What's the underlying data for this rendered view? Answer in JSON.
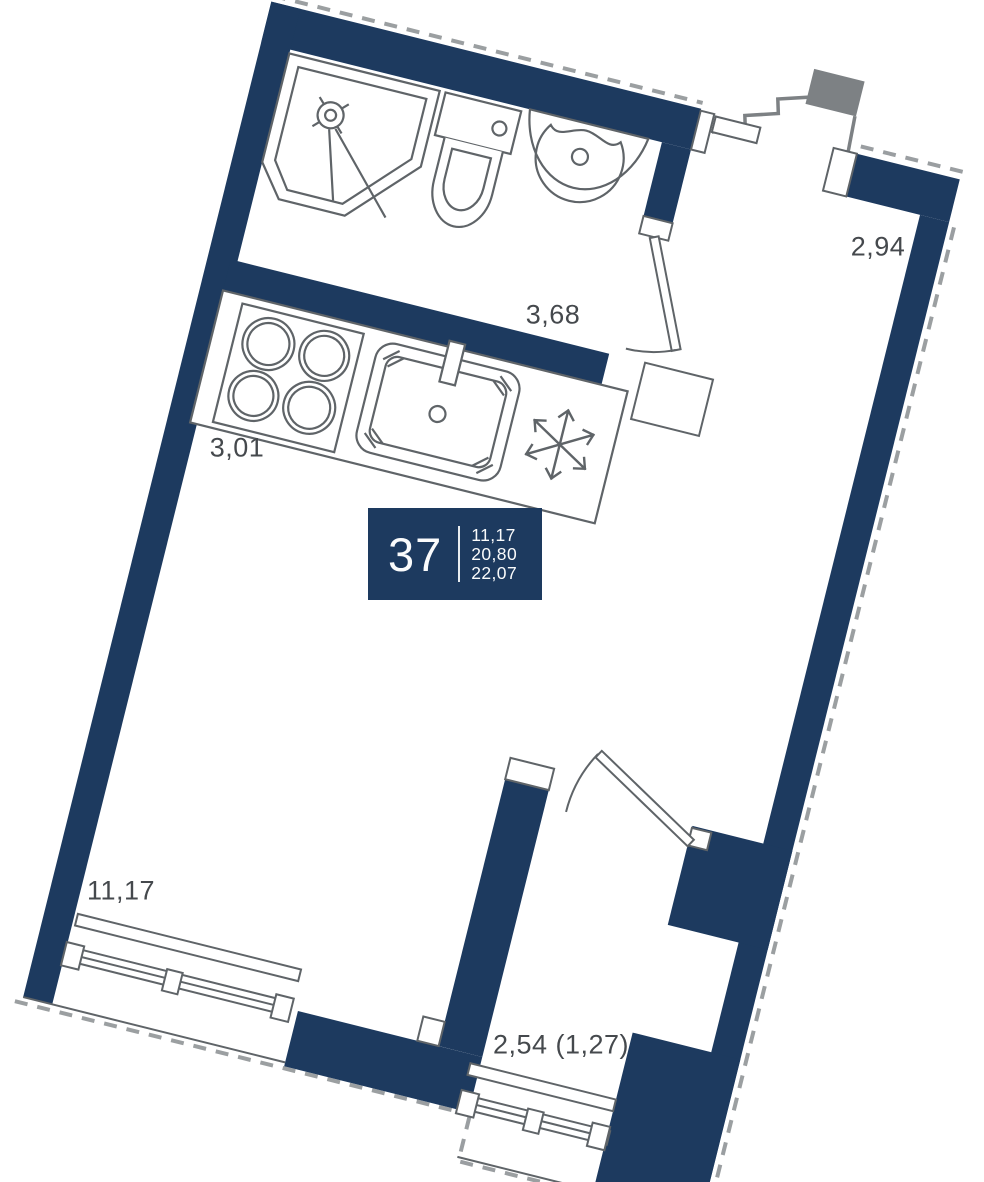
{
  "floorplan": {
    "unit_number": "37",
    "areas": {
      "living": "11,17",
      "total": "20,80",
      "overall": "22,07"
    },
    "dimension_labels": {
      "kitchen_wall": "3,68",
      "entry_hall": "2,94",
      "kitchen_depth": "3,01",
      "living_room": "11,17",
      "balcony": "2,54 (1,27)"
    },
    "colors": {
      "wall_navy": "#1d3a5f",
      "fixture_line_gray": "#5f6468",
      "context_gray": "#7d8184",
      "dashed_gray": "#82878a",
      "label_text": "#45494d",
      "info_box_text": "#fafbfc"
    },
    "icons": {
      "fridge": "snowflake-icon",
      "shower": "shower-head-icon"
    }
  }
}
